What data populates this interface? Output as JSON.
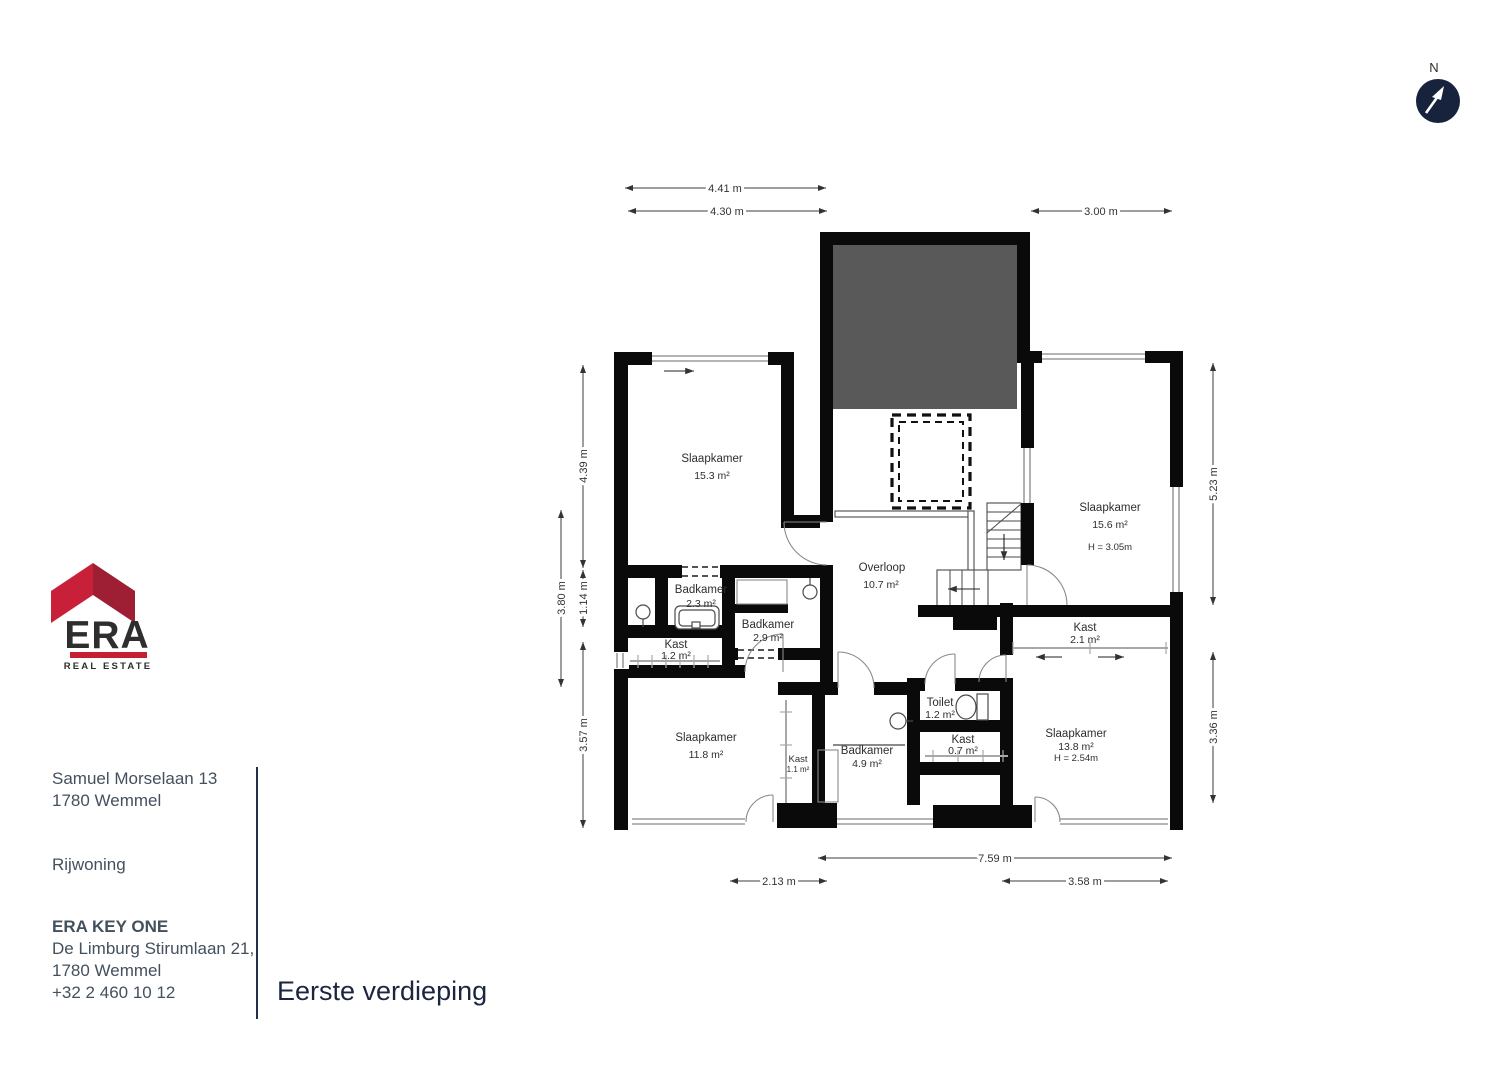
{
  "meta": {
    "floor_title": "Eerste verdieping",
    "north_label": "N"
  },
  "info_panel": {
    "property_address_line1": "Samuel Morselaan 13",
    "property_address_line2": "1780 Wemmel",
    "property_type": "Rijwoning",
    "agency_name": "ERA KEY ONE",
    "agency_address_line1": "De Limburg Stirumlaan 21,",
    "agency_address_line2": "1780 Wemmel",
    "agency_phone": "+32 2 460 10 12"
  },
  "logo": {
    "brand": "ERA",
    "tagline": "REAL ESTATE"
  },
  "rooms": [
    {
      "name": "Slaapkamer",
      "area": "15.3 m²"
    },
    {
      "name": "Slaapkamer",
      "area": "15.6 m²",
      "height": "H = 3.05m"
    },
    {
      "name": "Overloop",
      "area": "10.7 m²"
    },
    {
      "name": "Badkamer",
      "area": "2.3 m²"
    },
    {
      "name": "Badkamer",
      "area": "2.9 m²"
    },
    {
      "name": "Kast",
      "area": "1.2 m²"
    },
    {
      "name": "Slaapkamer",
      "area": "11.8 m²"
    },
    {
      "name": "Kast",
      "area": "1.1 m²"
    },
    {
      "name": "Badkamer",
      "area": "4.9 m²"
    },
    {
      "name": "Toilet",
      "area": "1.2 m²"
    },
    {
      "name": "Kast",
      "area": "0.7 m²"
    },
    {
      "name": "Kast",
      "area": "2.1 m²"
    },
    {
      "name": "Slaapkamer",
      "area": "13.8 m²",
      "height": "H = 2.54m"
    }
  ],
  "dimensions": {
    "top": [
      "4.41 m",
      "4.30 m",
      "3.00 m"
    ],
    "left": [
      "4.39 m",
      "3.80 m",
      "1.14 m",
      "3.57 m"
    ],
    "right": [
      "5.23 m",
      "3.36 m"
    ],
    "bottom": [
      "7.59 m",
      "2.13 m",
      "3.58 m"
    ]
  },
  "colors": {
    "wall": "#0a0a0a",
    "void_fill": "#595959",
    "window_line": "#9c9c9c",
    "dimension_line": "#3c3c3c",
    "panel_text": "#43505e",
    "title_text": "#1b2540",
    "brand_navy": "#2c2a6a",
    "brand_red_light": "#c9203a",
    "brand_red_dark": "#9e1e33",
    "brand_bar_red": "#c51f30",
    "compass_navy": "#17223c"
  }
}
